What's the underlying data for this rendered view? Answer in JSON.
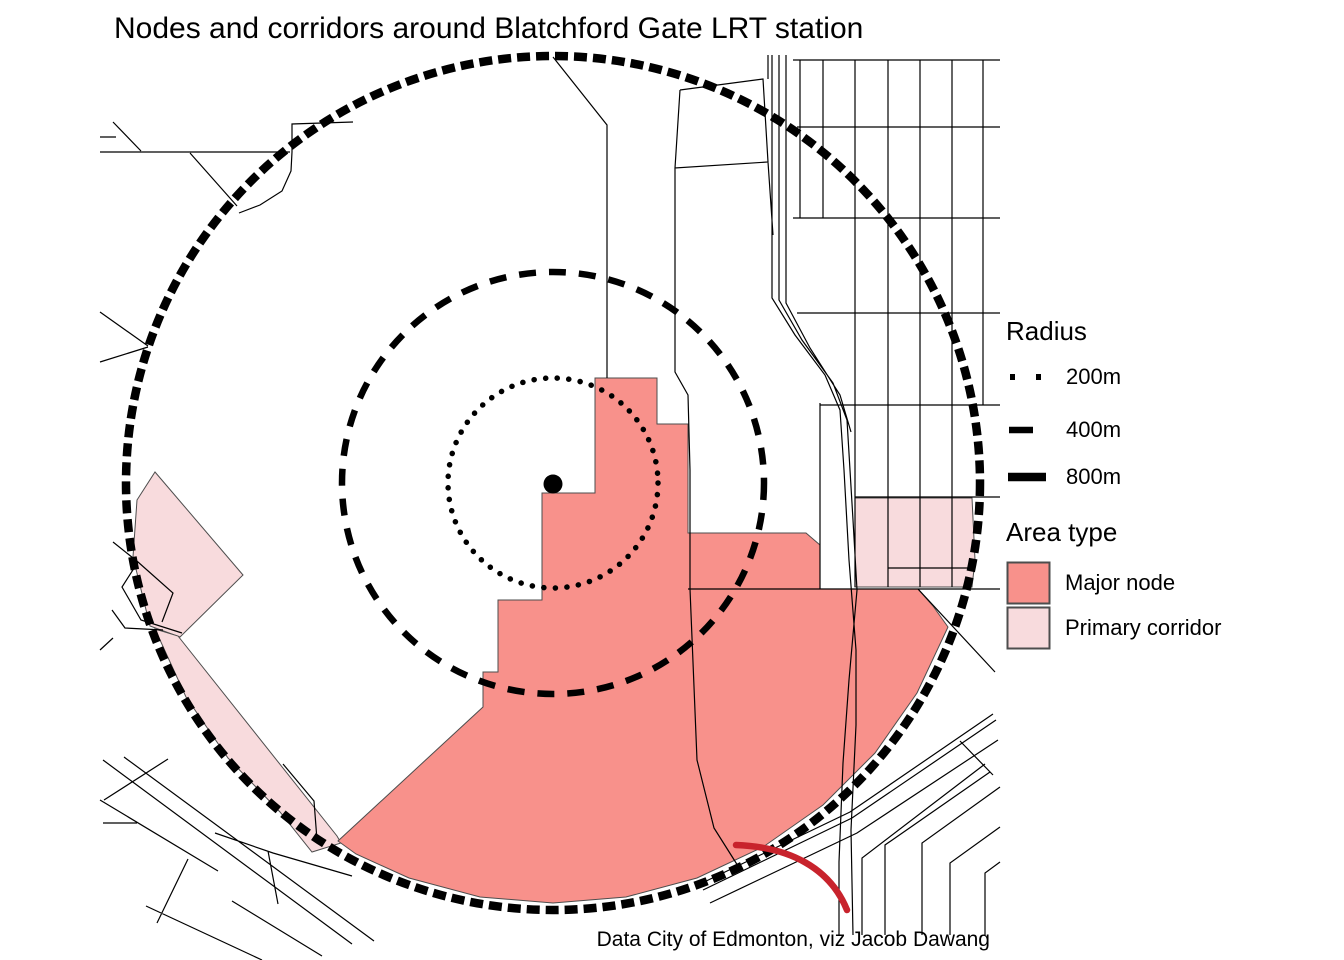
{
  "title": "Nodes and corridors around Blatchford Gate LRT station",
  "caption": "Data City of Edmonton, viz Jacob Dawang",
  "legend_radius": {
    "title": "Radius",
    "items": [
      {
        "label": "200m",
        "style": "dotted"
      },
      {
        "label": "400m",
        "style": "dashed"
      },
      {
        "label": "800m",
        "style": "solid-thick"
      }
    ]
  },
  "legend_area_type": {
    "title": "Area type",
    "items": [
      {
        "label": "Major node"
      },
      {
        "label": "Primary corridor"
      }
    ]
  },
  "colors": {
    "major_node": "#F8918B",
    "primary_corridor": "#F8DBDD",
    "ring": "#000000",
    "road": "#000000",
    "area_border": "#4D4D4D",
    "rail_red": "#C8232C",
    "background": "#FFFFFF"
  }
}
